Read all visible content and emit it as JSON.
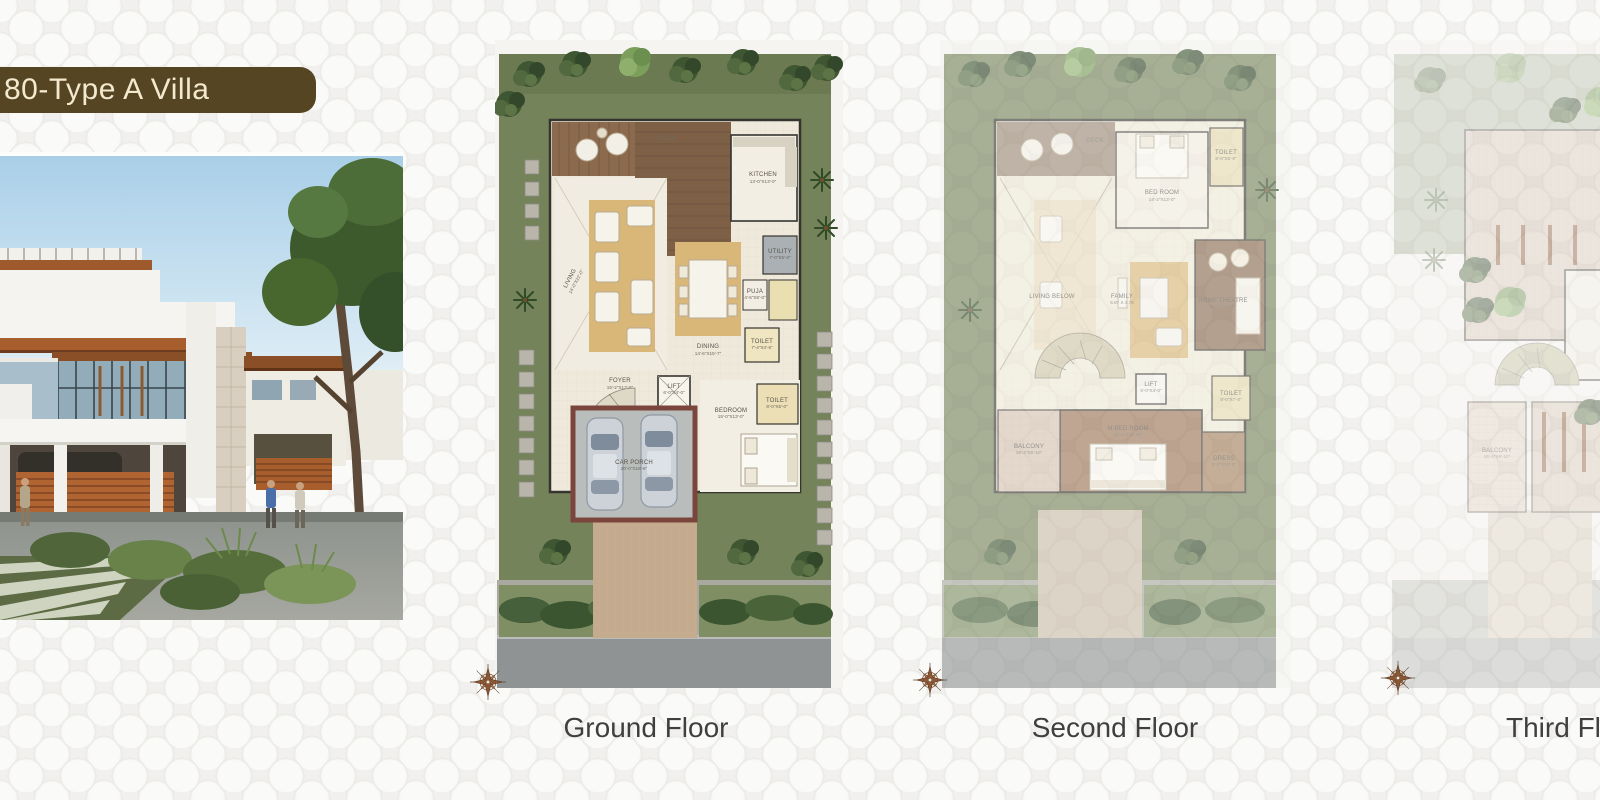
{
  "banner": {
    "title": "80-Type A Villa"
  },
  "photo": {
    "description": "villa exterior rendering"
  },
  "plans": [
    {
      "label": "Ground Floor",
      "compass_icon": "compass-rose",
      "rooms": {
        "deck": "DECK",
        "living": {
          "name": "LIVING",
          "dims": "14'-0\"X22'-0\""
        },
        "kitchen": {
          "name": "KITCHEN",
          "dims": "13'-0\"X13'-0\""
        },
        "dining": {
          "name": "DINING",
          "dims": "14'-6\"X15'-7\""
        },
        "utility": {
          "name": "UTILITY",
          "dims": "7'-0\"X5'-0\""
        },
        "puja": {
          "name": "PUJA",
          "dims": "4'-6\"X6'-0\""
        },
        "toilet": {
          "name": "TOILET",
          "dims": "7'-4\"X4'-6\""
        },
        "foyer": {
          "name": "FOYER",
          "dims": "15'-2\"X12'-8\""
        },
        "lift": {
          "name": "LIFT",
          "dims": "6'-0\"X4'-0\""
        },
        "car_porch": {
          "name": "CAR PORCH",
          "dims": "20'-0\"X18'-6\""
        },
        "bedroom": {
          "name": "BEDROOM",
          "dims": "15'-0\"X13'-0\""
        },
        "toilet2": {
          "name": "TOILET",
          "dims": "8'-0\"X5'-0\""
        }
      }
    },
    {
      "label": "Second Floor",
      "compass_icon": "compass-rose",
      "rooms": {
        "deck": "DECK",
        "living_below": "LIVING BELOW",
        "bed_room": {
          "name": "BED ROOM",
          "dims": "14'-2\"X13'-0\""
        },
        "toilet_a": {
          "name": "TOILET",
          "dims": "8'-0\"X5'-0\""
        },
        "family": {
          "name": "FAMILY",
          "dims": "5.87 X 4.75"
        },
        "home_theatre": {
          "name": "HOME THEATRE",
          "dims": "13'-2\"X16'-0\""
        },
        "toilet_b": {
          "name": "TOILET",
          "dims": "8'-0\"X7'-0\""
        },
        "lift": {
          "name": "LIFT",
          "dims": "6'-0\"X4'-0\""
        },
        "m_bed_room": {
          "name": "M.BED ROOM",
          "dims": "20'-2\"X15'-10\""
        },
        "dress": {
          "name": "DRESS",
          "dims": "9'-2\"X10'-0\""
        },
        "balcony": {
          "name": "BALCONY",
          "dims": "16'-4\"X6'-10\""
        }
      }
    },
    {
      "label": "Third Floor",
      "compass_icon": "compass-rose",
      "rooms": {
        "balcony": {
          "name": "BALCONY",
          "dims": "16'-4\"X6'-10\""
        }
      }
    }
  ],
  "colors": {
    "banner_bg": "#564522",
    "banner_text": "#f2e9cf",
    "floor_label": "#3f3f3f",
    "compass_brown": "#8a5634",
    "garden_green": "#75835a",
    "deck_brown": "#7d6047",
    "rug_tan": "#d9b778",
    "road_grey": "#8f9394",
    "driveway_tan": "#c5ab8e"
  }
}
